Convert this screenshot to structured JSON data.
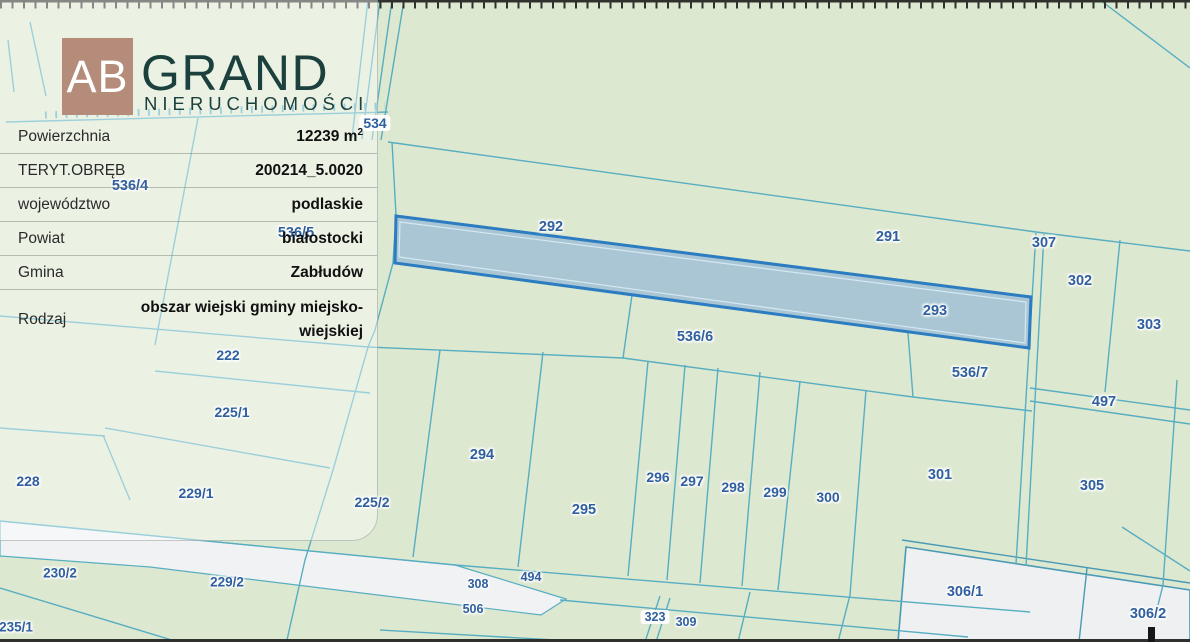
{
  "brand": {
    "initials": "AB",
    "name": "GRAND",
    "subtitle": "NIERUCHOMOŚCI",
    "square_color": "#b48c79",
    "text_color": "#1b403d"
  },
  "info_panel": {
    "rows": [
      {
        "label": "Powierzchnia",
        "value": "12239 m",
        "sup": "2"
      },
      {
        "label": "TERYT.OBRĘB",
        "value": "200214_5.0020"
      },
      {
        "label": "województwo",
        "value": "podlaskie"
      },
      {
        "label": "Powiat",
        "value": "białostocki"
      },
      {
        "label": "Gmina",
        "value": "Zabłudów"
      },
      {
        "label": "Rodzaj",
        "value": "obszar wiejski gminy miejsko-wiejskiej"
      }
    ]
  },
  "map": {
    "background_color": "#dde8d0",
    "boundary_line_color": "#57adc1",
    "road_fill_color": "#f0f2f3",
    "label_color": "#2f5f9e",
    "highlight": {
      "fill": "#a6c4d5",
      "stroke": "#2b7cc1",
      "area_label": "12239 m2"
    },
    "labels": [
      {
        "text": "534",
        "x": 375,
        "y": 123,
        "size": 14,
        "boxed": true
      },
      {
        "text": "536/4",
        "x": 130,
        "y": 186,
        "size": 14.5,
        "boxed": false
      },
      {
        "text": "536/5",
        "x": 296,
        "y": 233,
        "size": 14.5,
        "boxed": false
      },
      {
        "text": "292",
        "x": 551,
        "y": 227,
        "size": 14.5,
        "boxed": false
      },
      {
        "text": "291",
        "x": 888,
        "y": 237,
        "size": 14.5,
        "boxed": false
      },
      {
        "text": "307",
        "x": 1044,
        "y": 243,
        "size": 14.5,
        "boxed": false
      },
      {
        "text": "302",
        "x": 1080,
        "y": 281,
        "size": 14.5,
        "boxed": false
      },
      {
        "text": "303",
        "x": 1149,
        "y": 325,
        "size": 14.5,
        "boxed": false
      },
      {
        "text": "293",
        "x": 935,
        "y": 311,
        "size": 14.5,
        "boxed": false
      },
      {
        "text": "536/6",
        "x": 695,
        "y": 337,
        "size": 14.5,
        "boxed": false
      },
      {
        "text": "536/7",
        "x": 970,
        "y": 373,
        "size": 14.5,
        "boxed": false
      },
      {
        "text": "497",
        "x": 1104,
        "y": 402,
        "size": 14.5,
        "boxed": false
      },
      {
        "text": "222",
        "x": 228,
        "y": 355,
        "size": 14,
        "boxed": false
      },
      {
        "text": "225/1",
        "x": 232,
        "y": 412,
        "size": 14,
        "boxed": false
      },
      {
        "text": "294",
        "x": 482,
        "y": 455,
        "size": 14.5,
        "boxed": false
      },
      {
        "text": "295",
        "x": 584,
        "y": 510,
        "size": 14.5,
        "boxed": false
      },
      {
        "text": "296",
        "x": 658,
        "y": 477,
        "size": 14,
        "boxed": false
      },
      {
        "text": "297",
        "x": 692,
        "y": 481,
        "size": 14,
        "boxed": false
      },
      {
        "text": "298",
        "x": 733,
        "y": 487,
        "size": 14,
        "boxed": false
      },
      {
        "text": "299",
        "x": 775,
        "y": 492,
        "size": 14,
        "boxed": false
      },
      {
        "text": "300",
        "x": 828,
        "y": 497,
        "size": 14,
        "boxed": false
      },
      {
        "text": "301",
        "x": 940,
        "y": 475,
        "size": 14.5,
        "boxed": false
      },
      {
        "text": "305",
        "x": 1092,
        "y": 486,
        "size": 14.5,
        "boxed": false
      },
      {
        "text": "228",
        "x": 28,
        "y": 481,
        "size": 14,
        "boxed": false
      },
      {
        "text": "229/1",
        "x": 196,
        "y": 493,
        "size": 14,
        "boxed": false
      },
      {
        "text": "225/2",
        "x": 372,
        "y": 502,
        "size": 14,
        "boxed": false
      },
      {
        "text": "230/2",
        "x": 60,
        "y": 573,
        "size": 13.5,
        "boxed": false
      },
      {
        "text": "229/2",
        "x": 227,
        "y": 582,
        "size": 13.5,
        "boxed": false
      },
      {
        "text": "235/1",
        "x": 16,
        "y": 627,
        "size": 13.5,
        "boxed": false
      },
      {
        "text": "308",
        "x": 478,
        "y": 584,
        "size": 12.5,
        "boxed": false
      },
      {
        "text": "494",
        "x": 531,
        "y": 577,
        "size": 12.5,
        "boxed": false
      },
      {
        "text": "506",
        "x": 473,
        "y": 609,
        "size": 12.5,
        "boxed": false
      },
      {
        "text": "323",
        "x": 655,
        "y": 617,
        "size": 12.5,
        "boxed": true
      },
      {
        "text": "309",
        "x": 686,
        "y": 622,
        "size": 12.5,
        "boxed": false
      },
      {
        "text": "306/1",
        "x": 965,
        "y": 592,
        "size": 14.5,
        "boxed": false
      },
      {
        "text": "306/2",
        "x": 1148,
        "y": 614,
        "size": 14.5,
        "boxed": false
      }
    ]
  }
}
